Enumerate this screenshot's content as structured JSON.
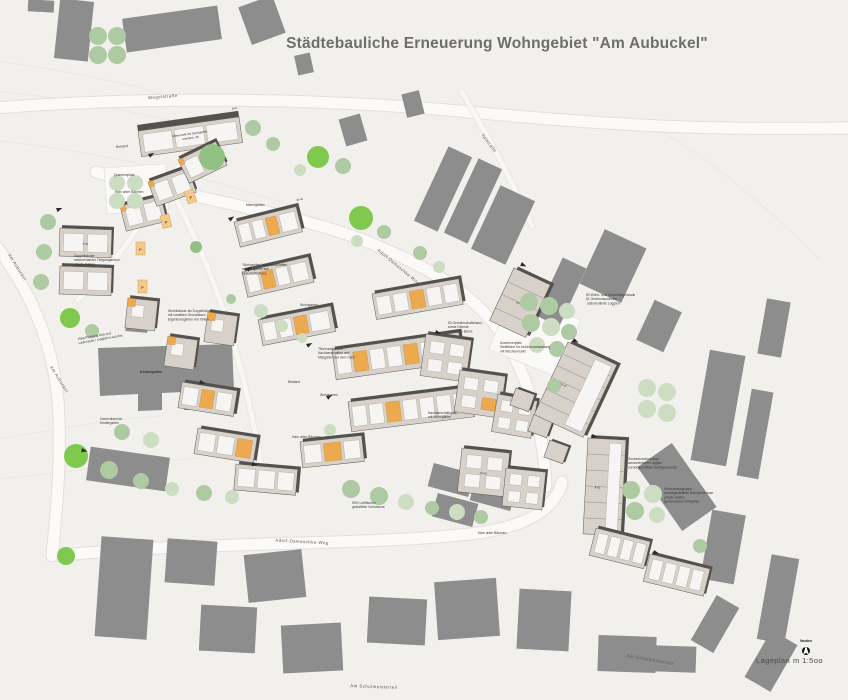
{
  "title": "Städtebauliche Erneuerung Wohngebiet  \"Am Aubuckel\"",
  "legend": {
    "plan_type": "Lageplan",
    "scale": "m 1:5oo",
    "north_label": "Norden"
  },
  "colors": {
    "background": "#f2f0ed",
    "existing_building": "#8d8d8d",
    "new_building_fill": "#d7d1c9",
    "new_building_edge": "#54524e",
    "unit_white": "#f6f5f3",
    "accent_orange": "#eda94e",
    "tree_pale": "#cdddc1",
    "tree_sage": "#aecaa3",
    "tree_mid": "#93c183",
    "tree_bright": "#7fc94e",
    "road": "#fbfaf9",
    "title_text": "#6e6e6e",
    "label_text": "#3b3b3b"
  },
  "streets": {
    "wegelstrasse": "Wegelstraße",
    "talstrasse": "Talstraße",
    "adolf_damaschke_ring": "Adolf-Damaschke-Ring",
    "adolf_damaschke_weg": "Adolf-Damaschke-Weg",
    "am_schulmeisterteil": "Am Schulmeisterteil",
    "am_aubuckel": "Am Aubuckel"
  },
  "annotations": {
    "mietercafe": [
      "Mietercafé mit Dachgarten",
      "erweitert, 36"
    ],
    "bestand": "Bestand",
    "quartiersplatz": "Quartiersplatz",
    "hain": "Hain unter Bäumen",
    "tiefgaragen": [
      "Doppelhäuser",
      "nebeneinander Tiefgaragenbox",
      "private Gärten"
    ],
    "doppelhaeuser": [
      "Wohnhäuser als Doppelhäuser",
      "mit variablen Grundrissen",
      "Eigentumsgärten von hinten"
    ],
    "weg_kita": [
      "Weg Richtung Kita und",
      "Ladenzeile / möglichst autofrei"
    ],
    "kindergarten": "Kindergarten",
    "gemeinbereich": [
      "Gemeinbereich",
      "Kindergarten"
    ],
    "mietergaerten": "Mietergärten",
    "wohngarten": "Wohngarten",
    "wohnzeilen1": [
      "\"Wohnzeilen\" Nachbarschaften",
      "mit Mietgärten auf",
      "dem Gartenhaus"
    ],
    "wohnzeilen2": [
      "\"Wohnzeilen\" mit",
      "Nachbarschaften und",
      "Mietgärten auf dem Dach"
    ],
    "legend_50_51": [
      "50  Wohn- und Geschäftsgebäude",
      "51  Geschosswohnen",
      "     südorientierte Loggien"
    ],
    "gemeinschaft_53": [
      "53  Gemeinschaftshaus",
      "sowie Dienste",
      "städtische Büros"
    ],
    "anwohnerplatz": [
      "Anwohnerplatz",
      "Stellfläche für Außenveranstaltung",
      "mit Wochenmarkt"
    ],
    "senioren": [
      "Seniorenwohnanlage",
      "westorientierte Loggien",
      "zurückgestaffelte Dachgeschosse"
    ],
    "reihenhaus": [
      "Reihenhausgruppe",
      "zurückgestaffelte Dachgeschosse",
      "private Gärten",
      "gemeinsamer Hofgarten"
    ],
    "luftflaechen": [
      "50% Luftflächen",
      "gestaffelte Vorhofzone"
    ],
    "nachbarschaft": [
      "Nachbarschaftsplatz",
      "mit Wohngärten"
    ]
  },
  "building_tags": {
    "small": "II+D",
    "mid": "III+D",
    "tall": "IV+D"
  },
  "markers": {
    "parking": "P"
  }
}
